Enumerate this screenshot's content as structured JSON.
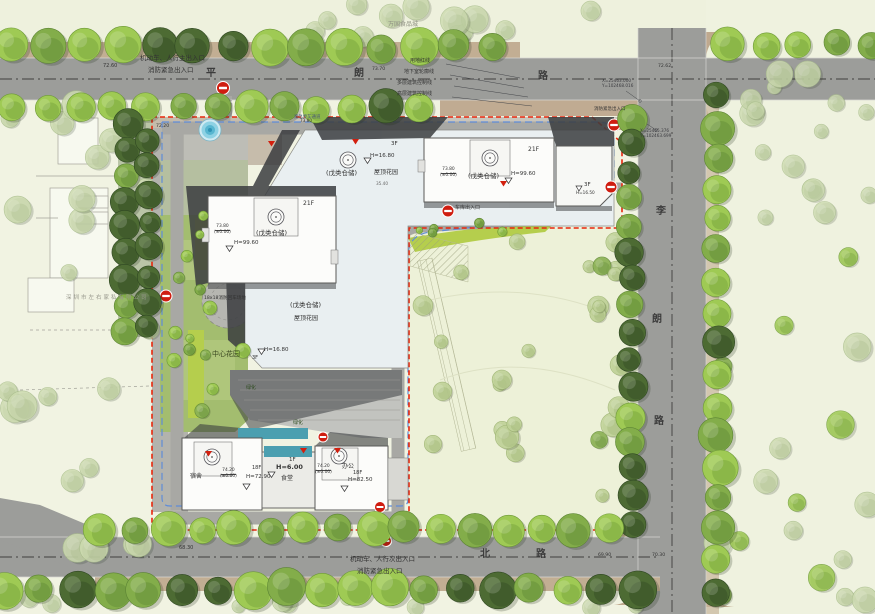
{
  "site": {
    "roads": {
      "north": {
        "chars": [
          "平",
          "朗",
          "路"
        ]
      },
      "east": {
        "chars": [
          "李",
          "朗",
          "路"
        ]
      },
      "south": {
        "chars": [
          "北",
          "路"
        ]
      }
    },
    "entrances": {
      "main_line1": "机动车、人行主出入口",
      "main_line2": "消防紧急出入口",
      "secondary_line1": "机动车、人行次出入口",
      "secondary_line2": "消防紧急出入口",
      "garage": "车库出入口",
      "east_fire": "消防紧急出入口"
    },
    "callouts": {
      "red_line": "用地红线",
      "basement": "地下室轮廓线",
      "multi": "多层建筑控制线",
      "highrise": "高层建筑控制线"
    },
    "context": {
      "food_city": "万国食品城",
      "company": "深圳市左右家私有限公司"
    },
    "coords": {
      "p1x": "X=25463.000",
      "p1y": "Y=102468.016",
      "p2x": "X=25465.376",
      "p2y": "Y=102463.699"
    },
    "features": {
      "central_garden": "中心花园",
      "fire_turnaround": "18x18消防回车场地",
      "greenery": "绿化",
      "emergency_lane": "紧急停车通道",
      "roof_garden": "屋顶花园"
    },
    "buildings": {
      "tower_a": {
        "floors": "21F",
        "level": "73.80",
        "datum": "(±0.00)",
        "use": "(戊类仓储)",
        "height": "H=99.60"
      },
      "tower_b": {
        "floors": "21F",
        "level": "73.80",
        "datum": "(±0.00)",
        "use": "(戊类仓储)",
        "height": "H=99.60"
      },
      "east_block": {
        "floors": "3F",
        "height": "H=16.50"
      },
      "podium": {
        "use": "(戊类仓储)",
        "garden": "屋顶花园",
        "height": "H=16.80",
        "floors": "3F",
        "dim": "35.40"
      },
      "leg": {
        "use": "(戊类仓储)",
        "garden": "屋顶花园",
        "height": "H=16.80",
        "floors": "3F"
      },
      "dorm": {
        "name": "宿舍",
        "level": "74.20",
        "datum": "(±0.00)",
        "height": "H=72.90",
        "floors": "18F"
      },
      "canteen": {
        "name": "食堂",
        "floors": "1F",
        "height": "H=6.00"
      },
      "office": {
        "name": "办公",
        "level": "74.20",
        "datum": "(±0.00)",
        "height": "H=82.50",
        "floors": "18F"
      }
    },
    "elevations": {
      "e1": "72.60",
      "e2": "73.70",
      "e3": "72.62",
      "e4": "72.20",
      "e5": "68.30",
      "e6": "69.90",
      "e7": "70.30",
      "e8": "73.80"
    }
  },
  "colors": {
    "boundary_red": "#e8260c",
    "basement_blue": "#5f8cd8",
    "road_grey": "#9c9d9a",
    "tree_green": "#7fae3f",
    "podium": "#e9eff1",
    "marker_red": "#cf1d10",
    "water": "#6cc4dc"
  }
}
